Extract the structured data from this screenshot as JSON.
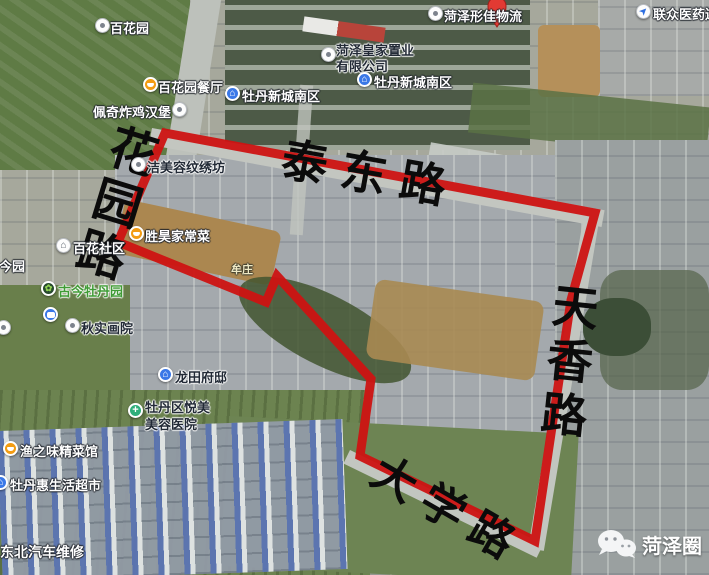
{
  "map": {
    "watermark": "菏泽圈",
    "road_labels": {
      "taidong": "泰东路",
      "tianxiang": "天香路",
      "daxue": "大学路",
      "huayuan": "花园路"
    },
    "pois": [
      {
        "label": "百花园",
        "icon": "white-dot"
      },
      {
        "label": "百花园餐厅",
        "icon": "restaurant"
      },
      {
        "label": "佩奇炸鸡汉堡",
        "icon": "white-dot"
      },
      {
        "label": "菏泽皇家置业",
        "label2": "有限公司",
        "icon": "white-dot"
      },
      {
        "label": "牡丹新城南区",
        "icon": "residence"
      },
      {
        "label": "牡丹新城南区",
        "icon": "residence"
      },
      {
        "label": "菏泽形佳物流",
        "icon": "white-dot"
      },
      {
        "label": "联众医药连锁",
        "icon": "compass"
      },
      {
        "label": "洁美容纹绣坊",
        "icon": "white-dot"
      },
      {
        "label": "胜昊家常菜",
        "icon": "restaurant"
      },
      {
        "label": "百花社区",
        "icon": "residence-white"
      },
      {
        "label": "古今园",
        "icon": "none"
      },
      {
        "label": "古今牡丹园",
        "icon": "garden"
      },
      {
        "label": "秋实画院",
        "icon": "white-dot"
      },
      {
        "label": "牟庄",
        "icon": "none"
      },
      {
        "label": "龙田府邸",
        "icon": "residence"
      },
      {
        "label": "牡丹区悦美",
        "label2": "美容医院",
        "icon": "hospital"
      },
      {
        "label": "渔之味精菜馆",
        "icon": "restaurant"
      },
      {
        "label": "牡丹惠生活超市",
        "icon": "shopping"
      },
      {
        "label": "东北汽车维修",
        "icon": "none"
      }
    ]
  },
  "icon_glyphs": {
    "residence": "⌂",
    "garden": "✿",
    "hospital": "+",
    "compass": "➤"
  },
  "colors": {
    "boundary": "#ce1312",
    "road_text": "#0b0b0b",
    "poi_blue": "#3a78e7",
    "poi_orange": "#f39c12",
    "poi_green": "#2fae7a",
    "pin_red": "#e23a33"
  }
}
